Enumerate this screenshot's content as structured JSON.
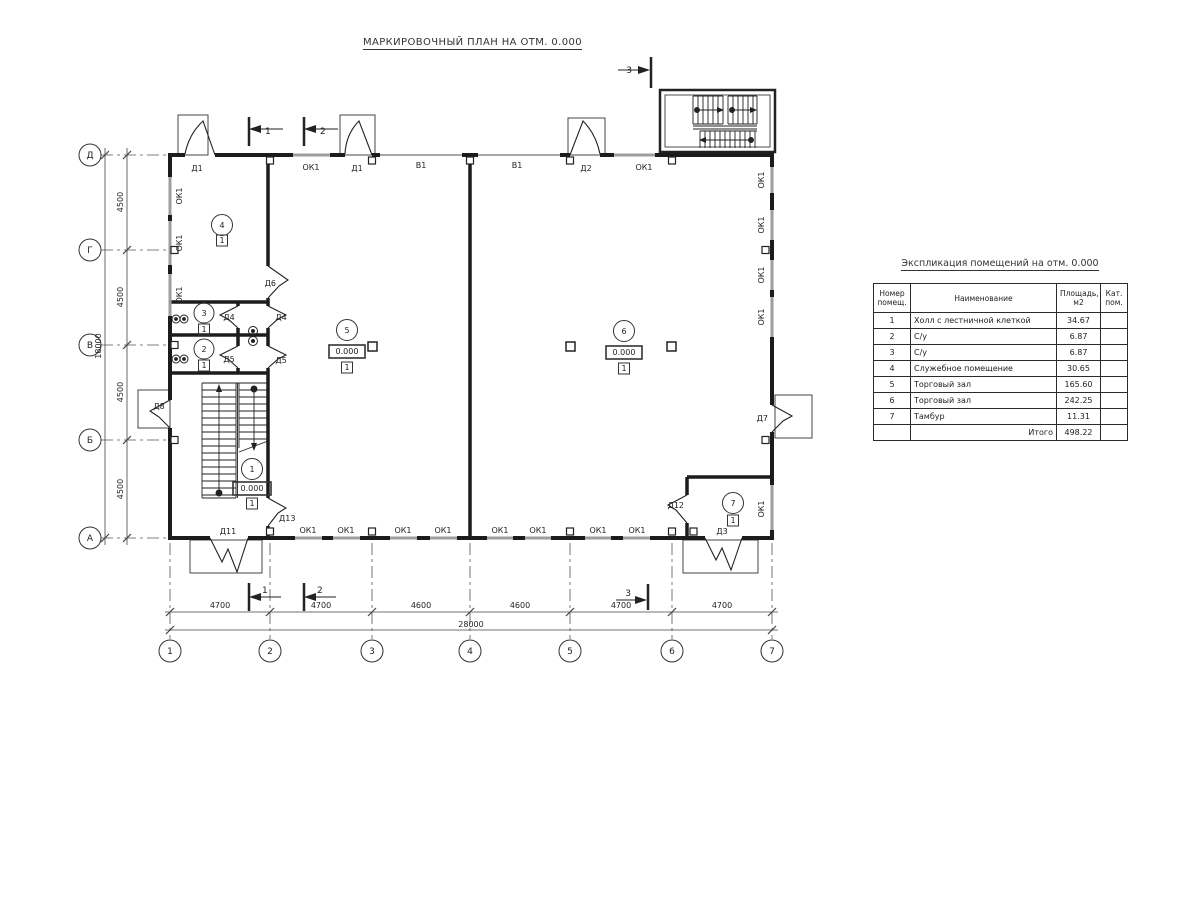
{
  "title": "МАРКИРОВОЧНЫЙ ПЛАН НА ОТМ. 0.000",
  "axes": {
    "rows": [
      "Д",
      "Г",
      "В",
      "Б",
      "А"
    ],
    "cols": [
      "1",
      "2",
      "3",
      "4",
      "5",
      "6",
      "7"
    ]
  },
  "dimensions": {
    "left": [
      "4500",
      "4500",
      "4500",
      "4500"
    ],
    "left_total": "18000",
    "bottom": [
      "4700",
      "4700",
      "4600",
      "4600",
      "4700",
      "4700"
    ],
    "bottom_total": "28000"
  },
  "sections": {
    "s1": "1",
    "s2": "2",
    "s3": "3"
  },
  "openings": {
    "top": [
      "Д1",
      "ОК1",
      "Д1",
      "В1",
      "В1",
      "Д2",
      "ОК1"
    ],
    "bottom": [
      "Д11",
      "ОК1",
      "ОК1",
      "ОК1",
      "ОК1",
      "ОК1",
      "ОК1",
      "ОК1",
      "ОК1",
      "Д3"
    ],
    "left": [
      "ОК1",
      "ОК1",
      "ОК1",
      "Д8"
    ],
    "right": [
      "ОК1",
      "ОК1",
      "ОК1",
      "ОК1",
      "Д7",
      "ОК1"
    ],
    "interior": [
      "Д6",
      "Д4",
      "Д4",
      "Д5",
      "Д5",
      "Д13",
      "Д12"
    ]
  },
  "markers": {
    "room1": {
      "num": "1",
      "elev": "0.000",
      "floor": "1"
    },
    "room2": {
      "num": "2",
      "floor": "1"
    },
    "room3": {
      "num": "3",
      "floor": "1"
    },
    "room4": {
      "num": "4",
      "floor": "1"
    },
    "room5": {
      "num": "5",
      "elev": "0.000",
      "floor": "1"
    },
    "room6": {
      "num": "6",
      "elev": "0.000",
      "floor": "1"
    },
    "room7": {
      "num": "7",
      "floor": "1"
    }
  },
  "table": {
    "title": "Экспликация помещений на отм. 0.000",
    "headers": {
      "num": "Номер помещ.",
      "name": "Наименование",
      "area": "Площадь,  м2",
      "cat": "Кат. пом."
    },
    "rows": [
      {
        "num": "1",
        "name": "Холл с лестничной клеткой",
        "area": "34.67",
        "cat": ""
      },
      {
        "num": "2",
        "name": "С/у",
        "area": "6.87",
        "cat": ""
      },
      {
        "num": "3",
        "name": "С/у",
        "area": "6.87",
        "cat": ""
      },
      {
        "num": "4",
        "name": "Служебное помещение",
        "area": "30.65",
        "cat": ""
      },
      {
        "num": "5",
        "name": "Торговый зал",
        "area": "165.60",
        "cat": ""
      },
      {
        "num": "6",
        "name": "Торговый зал",
        "area": "242.25",
        "cat": ""
      },
      {
        "num": "7",
        "name": "Тамбур",
        "area": "11.31",
        "cat": ""
      }
    ],
    "total_label": "Итого",
    "total_value": "498.22"
  },
  "colors": {
    "line": "#222222",
    "window": "#9e9e9e",
    "background": "#ffffff"
  }
}
